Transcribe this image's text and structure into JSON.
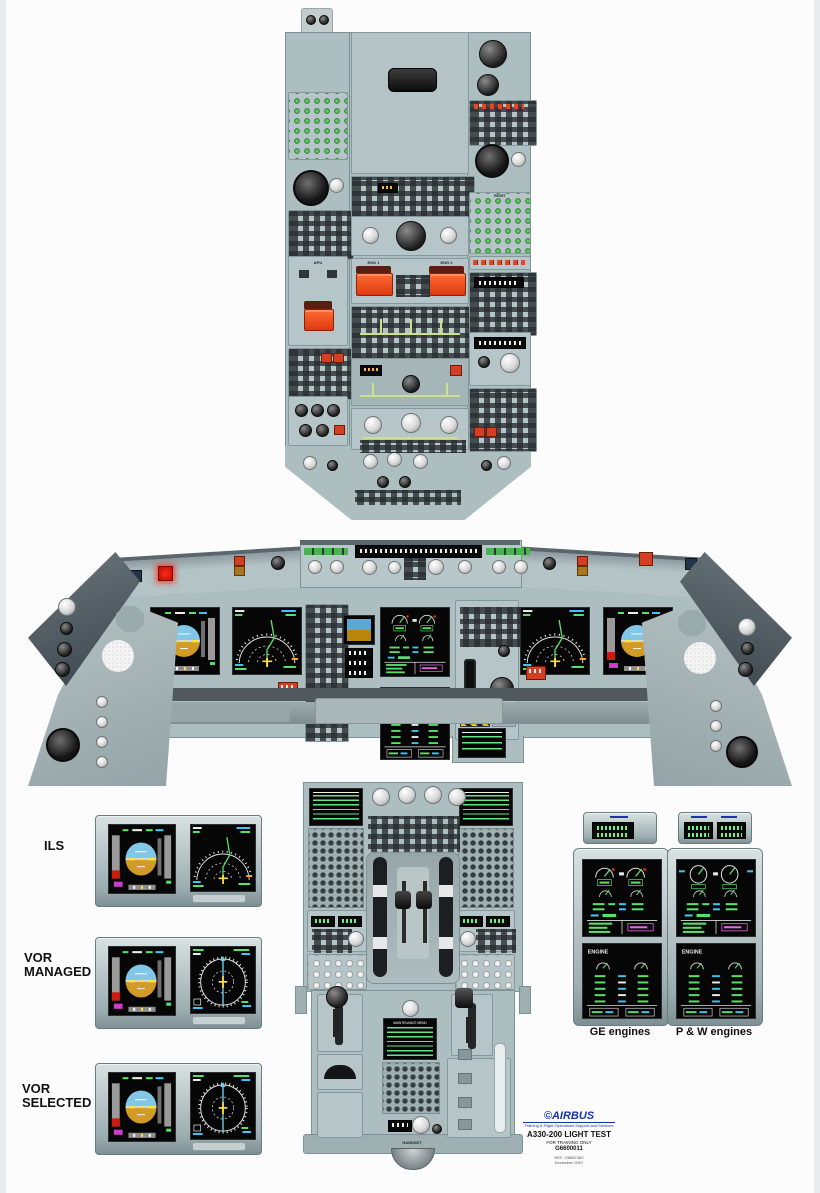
{
  "example_labels": {
    "ils": "ILS",
    "vor": "VOR",
    "managed": "MANAGED",
    "selected": "SELECTED",
    "ge": "GE engines",
    "pw": "P & W engines"
  },
  "overhead": {
    "eng1": "ENG 1",
    "eng2": "ENG 2",
    "apu": "APU",
    "reset": "RESET"
  },
  "pedestal": {
    "handset": "HANDSET",
    "maintenance_title": "MAINTENANCE MENU"
  },
  "displays": {
    "engine_page": "ENGINE"
  },
  "footer": {
    "copyright": "©",
    "brand": "AIRBUS",
    "tagline": "Training & Flight Operations Support and Services",
    "title": "A330-200 LIGHT TEST",
    "subtitle": "FOR TRAINING ONLY",
    "doc_number": "G6600011",
    "ref": "REF: G6687483",
    "date": "December 2007"
  },
  "colors": {
    "panel_gray": "#adbec1",
    "screen_black": "#060606",
    "sky_blue": "#82c7e8",
    "ground_amber": "#d29a27",
    "fire_red": "#dd3a10",
    "button_green": "#35b33a",
    "airbus_blue": "#1733a8"
  }
}
